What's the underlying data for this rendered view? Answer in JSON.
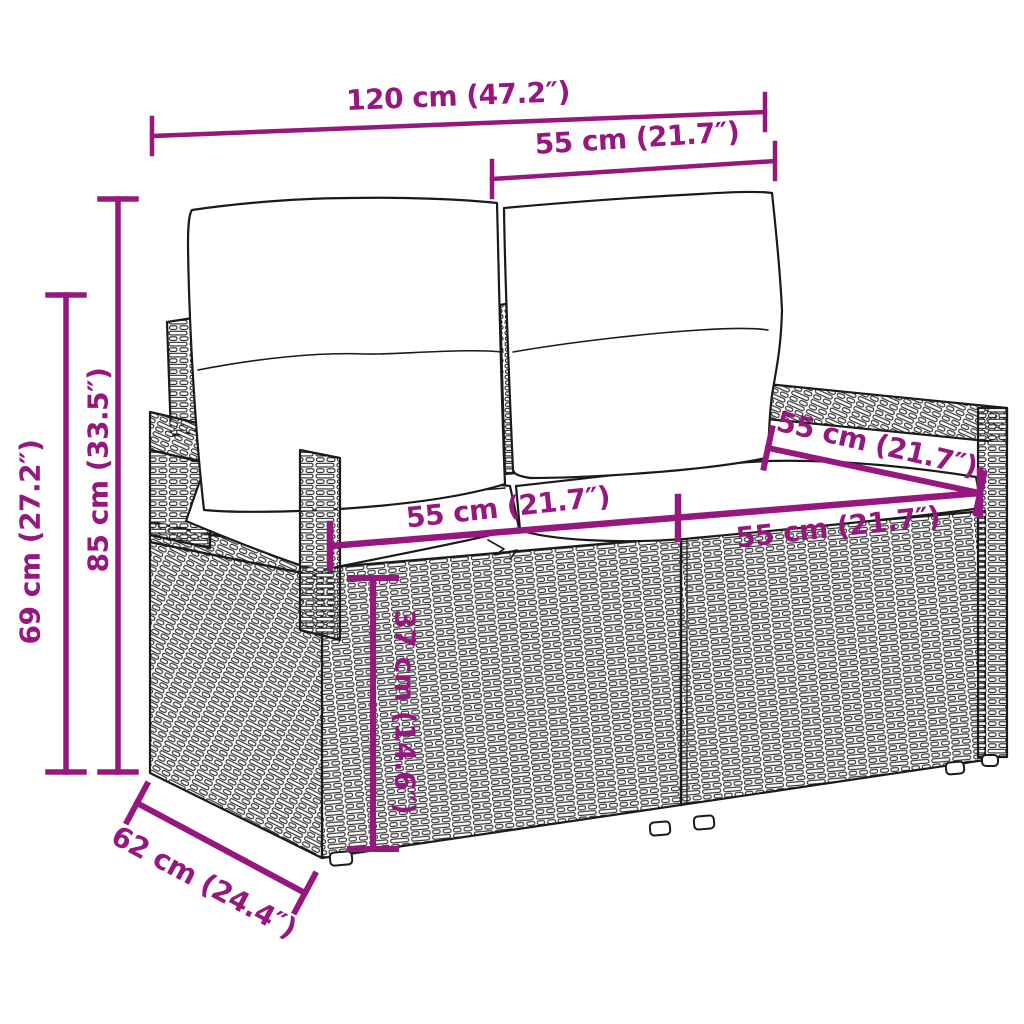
{
  "diagram": {
    "dimensions": {
      "total_width": "120 cm (47.2″)",
      "back_section_width": "55 cm (21.7″)",
      "total_height": "85 cm (33.5″)",
      "armrest_height": "69 cm (27.2″)",
      "left_seat_width": "55 cm (21.7″)",
      "right_seat_width": "55 cm (21.7″)",
      "seat_depth": "55 cm (21.7″)",
      "seat_height": "37 cm (14.6″)",
      "total_depth": "62 cm (24.4″)"
    },
    "colors": {
      "dimension": "#96187E",
      "line_art": "#1A1A1A",
      "background": "#FFFFFF"
    }
  }
}
